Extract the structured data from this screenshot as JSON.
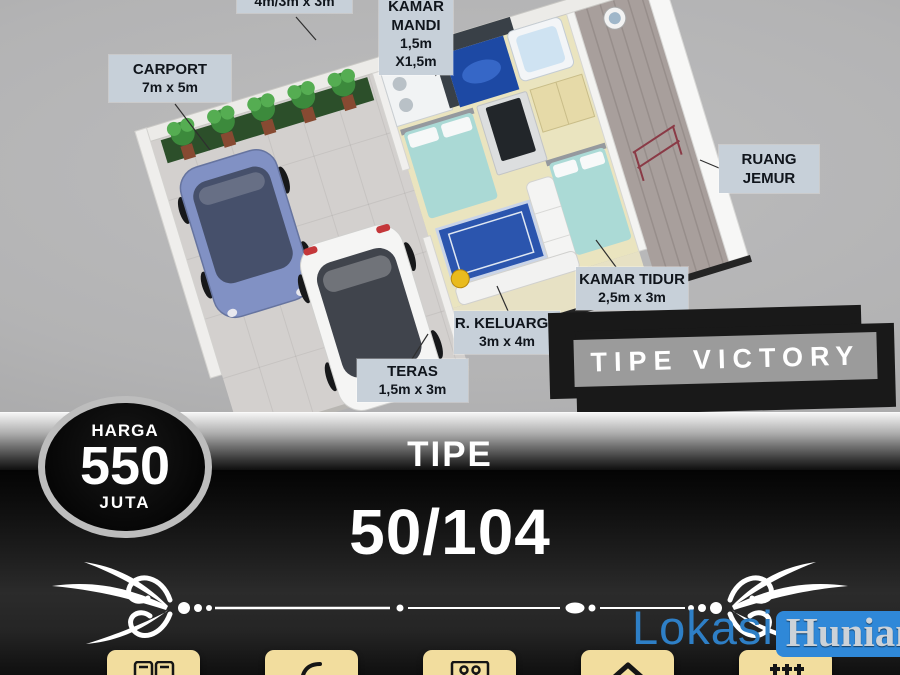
{
  "floor_plan": {
    "labels": {
      "partial_top": {
        "size": "4m/3m x 3m"
      },
      "kamar_mandi": {
        "title": "KAMAR MANDI",
        "size": "1,5m X1,5m"
      },
      "carport": {
        "title": "CARPORT",
        "size": "7m x 5m"
      },
      "ruang_jemur": {
        "title": "RUANG JEMUR"
      },
      "kamar_tidur": {
        "title": "KAMAR TIDUR",
        "size": "2,5m x 3m"
      },
      "r_keluarga": {
        "title": "R. KELUARGA",
        "size": "3m x 4m"
      },
      "teras": {
        "title": "TERAS",
        "size": "1,5m x 3m"
      }
    },
    "banner": {
      "label": "TIPE VICTORY"
    }
  },
  "price_badge": {
    "label_top": "HARGA",
    "value": "550",
    "label_bottom": "JUTA"
  },
  "type_info": {
    "label": "TIPE",
    "value": "50/104"
  },
  "brand": {
    "name_part1": "Lokasi",
    "name_part2": "Hunian"
  },
  "footer": {
    "icons": [
      {
        "name": "cards-icon"
      },
      {
        "name": "phone-icon"
      },
      {
        "name": "gallery-icon"
      },
      {
        "name": "house-icon"
      },
      {
        "name": "signature-icon"
      }
    ]
  },
  "colors": {
    "accent_blue": "#2e86d6",
    "label_bg": "#c7d0d9",
    "tile_cream": "#f2dd9e",
    "banner_gray": "#9b9b9b",
    "banner_black": "#191919",
    "bed_teal": "#aad9d5",
    "carpet_blue": "#2b55ae"
  }
}
